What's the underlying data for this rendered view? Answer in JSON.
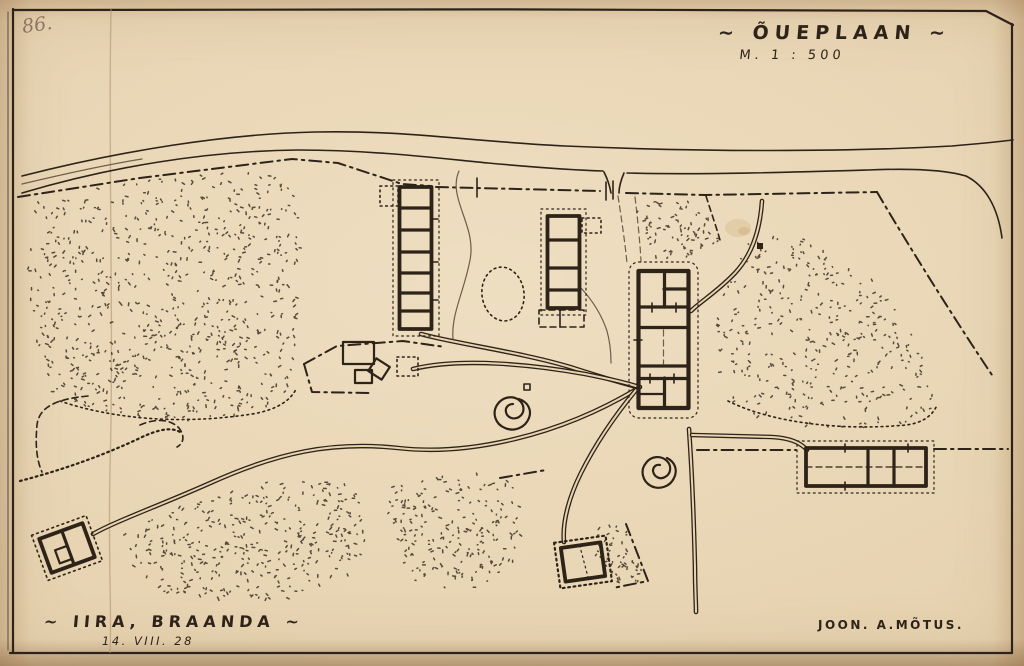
{
  "document": {
    "page_number": "86.",
    "title": "~ ÕUEPLAAN ~",
    "scale": "M. 1 : 500",
    "caption": "~ IIRA, BRAANDA ~",
    "date": "14. VIII. 28",
    "credit": "JOON. A.MÕTUS."
  },
  "colors": {
    "paper": "#e7d3b1",
    "ink": "#2e2318",
    "faded_ink": "#6f5d48",
    "pencil_note": "#8d7465"
  },
  "plan": {
    "type": "farmstead-site-plan",
    "features": [
      "road",
      "property-boundary",
      "west-barn",
      "north-barn",
      "main-house",
      "east-building",
      "southwest-outbuilding",
      "south-outbuilding",
      "farmyard-structures",
      "trees",
      "vegetation-stipple",
      "farm-paths",
      "field-boundaries",
      "fold-crease",
      "border-frame"
    ]
  }
}
